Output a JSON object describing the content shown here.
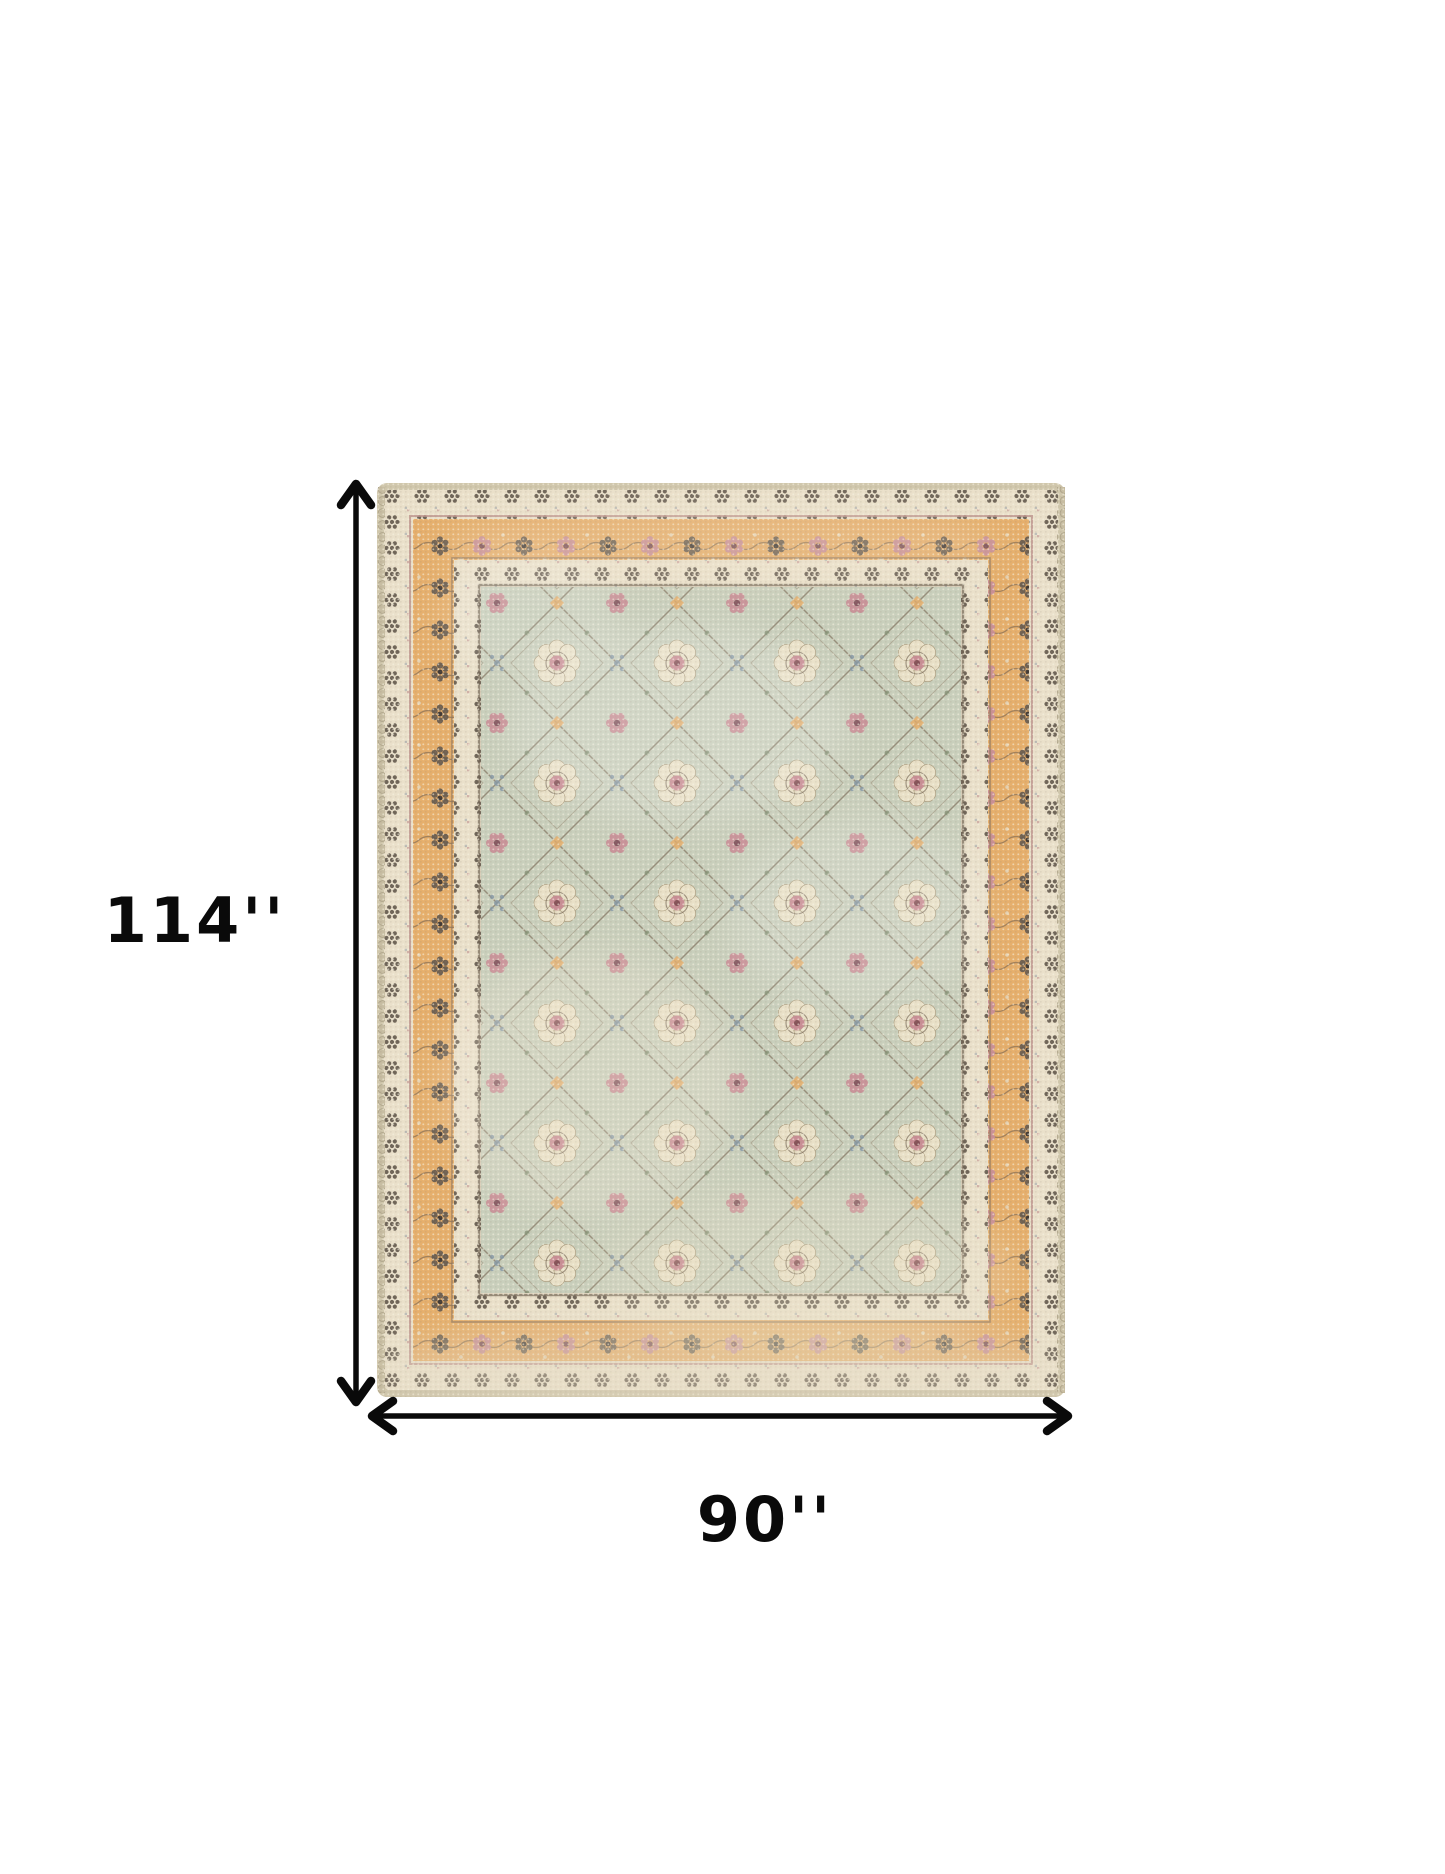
{
  "diagram": {
    "height_label": "114''",
    "width_label": "90''"
  },
  "icons": {
    "vertical_arrow": "double-headed-vertical-dimension-arrow",
    "horizontal_arrow": "double-headed-horizontal-dimension-arrow"
  },
  "colors": {
    "background": "#ffffff",
    "arrow": "#0a0a0a",
    "label_text": "#0a0a0a",
    "rug_edge": "#cfc4a6",
    "rug_cream": "#eadfc6",
    "rug_orange": "#e9aa5e",
    "rug_field": "#c7cdb8",
    "rug_pink": "#cb8790",
    "rug_dark_motif": "#5d5145"
  }
}
